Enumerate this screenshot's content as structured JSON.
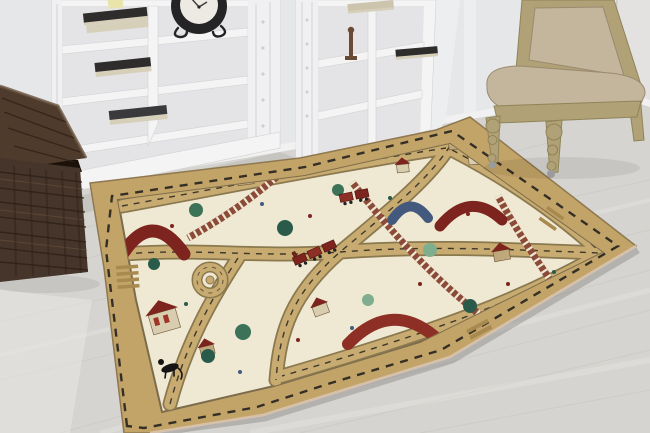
{
  "scene": {
    "type": "photograph",
    "description": "Bright room with two white cube bookshelves holding books, a black table clock and a candle; a dark wicker trunk with open lid at left; a beige upholstered chair with carved wooden legs at right; a large children's road-and-railway play rug lying on light grey laminate flooring",
    "objects": [
      "wall",
      "laminate-floor",
      "left-bookshelf",
      "right-bookshelf",
      "table-clock",
      "books",
      "candle",
      "candlestick-figurine",
      "wicker-trunk",
      "upholstered-chair",
      "kids-road-play-rug"
    ]
  },
  "rug": {
    "motifs": [
      "dashed-border-road",
      "tan-roads-with-dashed-centerline",
      "railway-tracks",
      "level-crossing-stripes",
      "maroon-bridges",
      "blue-bridge",
      "houses",
      "big-house-with-red-windows",
      "trees",
      "toy-trains",
      "roundabout",
      "flowers",
      "black-cat"
    ],
    "palette_note": "beige border, cream field, maroon houses and bridges, green trees, one blue bridge"
  },
  "colors": {
    "wall": "#e6e7e9",
    "wallRight": "#e3e2e0",
    "cornerLine": "#c9cacc",
    "baseboard": "#f1f1f2",
    "baseboardEdge": "#c2c2c4",
    "floor": "#d6d4d0",
    "floorGrain": "#c6c4c0",
    "floorLight": "#e8e6e2",
    "shelf": "#f4f4f5",
    "shelfRecess": "#e4e4e6",
    "shelfEdge": "#d2d2d4",
    "bookDark": "#2e2d2b",
    "bookGray": "#3a3a3c",
    "bookTan": "#cdc4ae",
    "pages": "#d6cfba",
    "candle": "#e9e5aa",
    "clockBody": "#242426",
    "clockFace": "#eceae2",
    "clockHand": "#3a3a3a",
    "basket": "#46352a",
    "basketDark": "#2c1f16",
    "basketLight": "#6a5440",
    "basketLid": "#4e3b2c",
    "basketInterior": "#1d1209",
    "chairWood": "#b1a176",
    "chairWoodDark": "#8f8458",
    "chairFabric": "#c4b59d",
    "chairFabricDark": "#a79a7e",
    "caster": "#9b9b9d",
    "rugBorder": "#c3a468",
    "rugBorderEdge": "#8f7850",
    "rugBinding": "#dec8b2",
    "rugField": "#efe8d2",
    "rugFieldEdge": "#7d6c4c",
    "road": "#c8ab70",
    "roadEdge": "#8a784f",
    "stripeBar": "#a8894f",
    "dashLine": "#1b1b1b",
    "rail": "#8c4a38",
    "maroon": "#7c241d",
    "red": "#8d2f24",
    "blue": "#44597e",
    "treeDark": "#2a5b4a",
    "tree": "#3c7258",
    "treeLight": "#7fae8e",
    "houseWall": "#d9cdb0",
    "houseTan": "#bfa97c",
    "windowRed": "#a03426",
    "cat": "#141414"
  }
}
